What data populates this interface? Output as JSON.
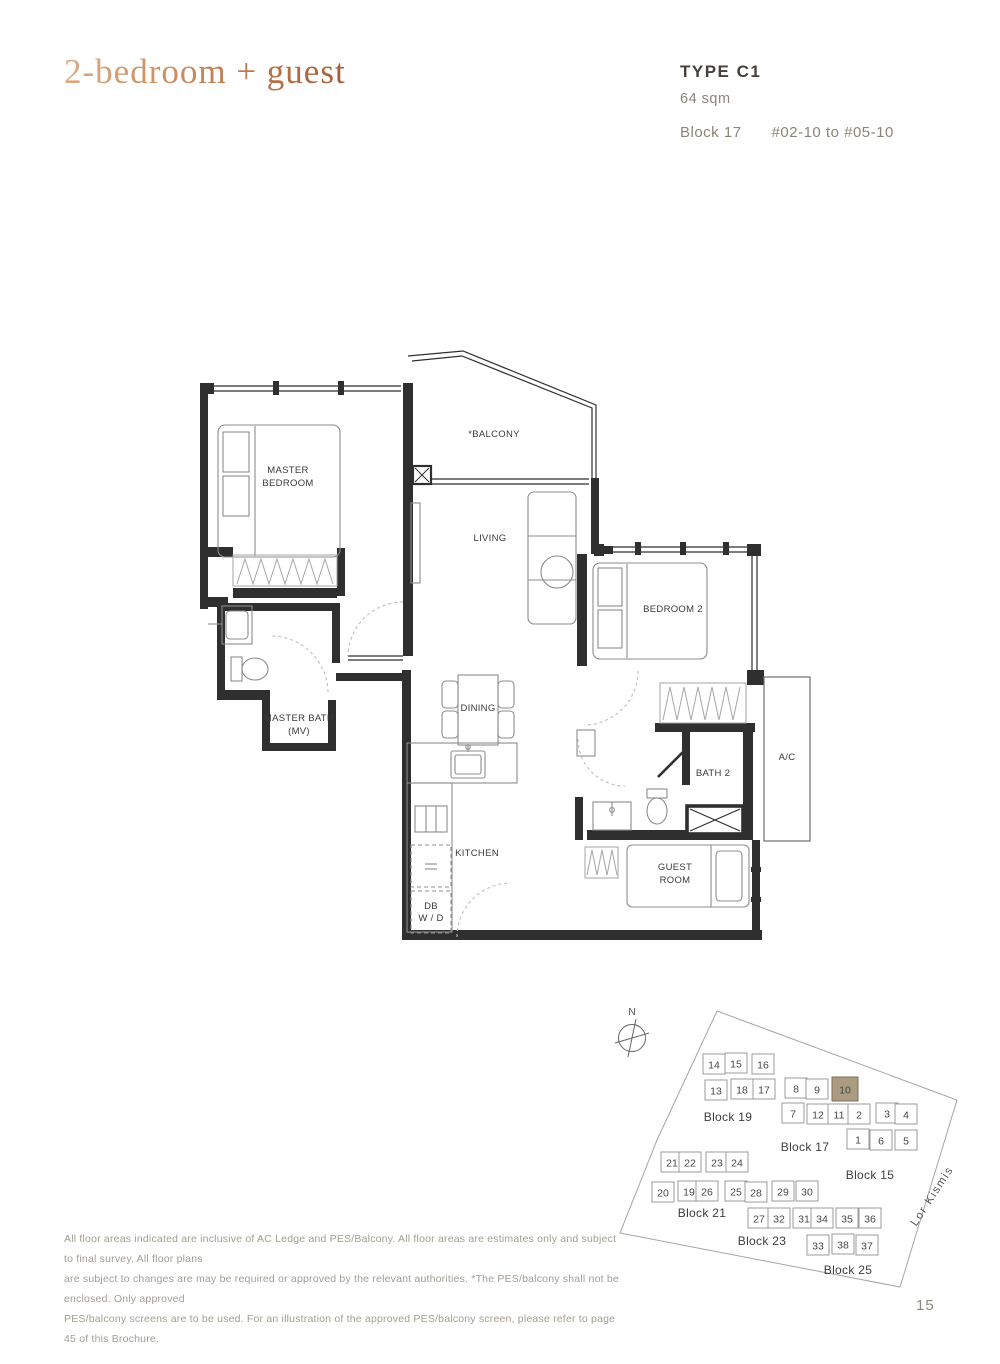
{
  "header": {
    "title": "2-bedroom + guest",
    "type": "TYPE C1",
    "area": "64 sqm",
    "block": "Block 17",
    "units": "#02-10 to #05-10"
  },
  "floorplan": {
    "rooms": {
      "master_bedroom": [
        "MASTER",
        "BEDROOM"
      ],
      "balcony": "*BALCONY",
      "living": "LIVING",
      "bedroom2": "BEDROOM 2",
      "master_bath": [
        "MASTER BATH",
        "(MV)"
      ],
      "dining": "DINING",
      "bath2": "BATH 2",
      "ac": "A/C",
      "kitchen": "KITCHEN",
      "db_wd": [
        "DB",
        "W / D"
      ],
      "guest": [
        "GUEST",
        "ROOM"
      ]
    }
  },
  "sitemap": {
    "compass": "N",
    "road": "Lor Kismis",
    "highlighted_unit": "10",
    "highlight_color": "#ab9b82",
    "highlight_stroke": "#7d6f58",
    "units": [
      {
        "n": "14",
        "x": 106,
        "y": 63
      },
      {
        "n": "15",
        "x": 128,
        "y": 62
      },
      {
        "n": "16",
        "x": 155,
        "y": 63
      },
      {
        "n": "13",
        "x": 108,
        "y": 89
      },
      {
        "n": "18",
        "x": 134,
        "y": 88
      },
      {
        "n": "17",
        "x": 156,
        "y": 88
      },
      {
        "n": "8",
        "x": 188,
        "y": 87
      },
      {
        "n": "9",
        "x": 209,
        "y": 88
      },
      {
        "n": "10",
        "x": 237,
        "y": 88
      },
      {
        "n": "7",
        "x": 185,
        "y": 112
      },
      {
        "n": "12",
        "x": 210,
        "y": 113
      },
      {
        "n": "11",
        "x": 231,
        "y": 113
      },
      {
        "n": "2",
        "x": 251,
        "y": 113
      },
      {
        "n": "3",
        "x": 279,
        "y": 112
      },
      {
        "n": "4",
        "x": 298,
        "y": 113
      },
      {
        "n": "1",
        "x": 250,
        "y": 138
      },
      {
        "n": "6",
        "x": 273,
        "y": 139
      },
      {
        "n": "5",
        "x": 298,
        "y": 139
      },
      {
        "n": "21",
        "x": 64,
        "y": 161
      },
      {
        "n": "22",
        "x": 82,
        "y": 161
      },
      {
        "n": "23",
        "x": 109,
        "y": 161
      },
      {
        "n": "24",
        "x": 129,
        "y": 161
      },
      {
        "n": "20",
        "x": 55,
        "y": 191
      },
      {
        "n": "19",
        "x": 81,
        "y": 190
      },
      {
        "n": "26",
        "x": 99,
        "y": 190
      },
      {
        "n": "25",
        "x": 128,
        "y": 190
      },
      {
        "n": "28",
        "x": 148,
        "y": 191
      },
      {
        "n": "29",
        "x": 175,
        "y": 190
      },
      {
        "n": "30",
        "x": 199,
        "y": 190
      },
      {
        "n": "27",
        "x": 151,
        "y": 217
      },
      {
        "n": "32",
        "x": 171,
        "y": 217
      },
      {
        "n": "31",
        "x": 196,
        "y": 217
      },
      {
        "n": "34",
        "x": 214,
        "y": 217
      },
      {
        "n": "35",
        "x": 239,
        "y": 217
      },
      {
        "n": "36",
        "x": 262,
        "y": 217
      },
      {
        "n": "33",
        "x": 210,
        "y": 244
      },
      {
        "n": "38",
        "x": 235,
        "y": 243
      },
      {
        "n": "37",
        "x": 259,
        "y": 244
      }
    ],
    "blocks": [
      {
        "label": "Block 19",
        "x": 120,
        "y": 115
      },
      {
        "label": "Block 17",
        "x": 197,
        "y": 145
      },
      {
        "label": "Block 15",
        "x": 262,
        "y": 173
      },
      {
        "label": "Block 21",
        "x": 94,
        "y": 211
      },
      {
        "label": "Block 23",
        "x": 154,
        "y": 239
      },
      {
        "label": "Block 25",
        "x": 240,
        "y": 268
      }
    ]
  },
  "disclaimer": {
    "lines": [
      "All floor areas indicated are inclusive of AC Ledge and PES/Balcony. All floor areas are estimates only and subject to final survey. All floor plans",
      "are subject to changes are may be required or approved by the relevant authorities. *The PES/balcony shall not be enclosed. Only approved",
      "PES/balcony screens are to be used. For an illustration of the approved PES/balcony screen, please refer to page 45 of this Brochure."
    ]
  },
  "page_number": "15"
}
